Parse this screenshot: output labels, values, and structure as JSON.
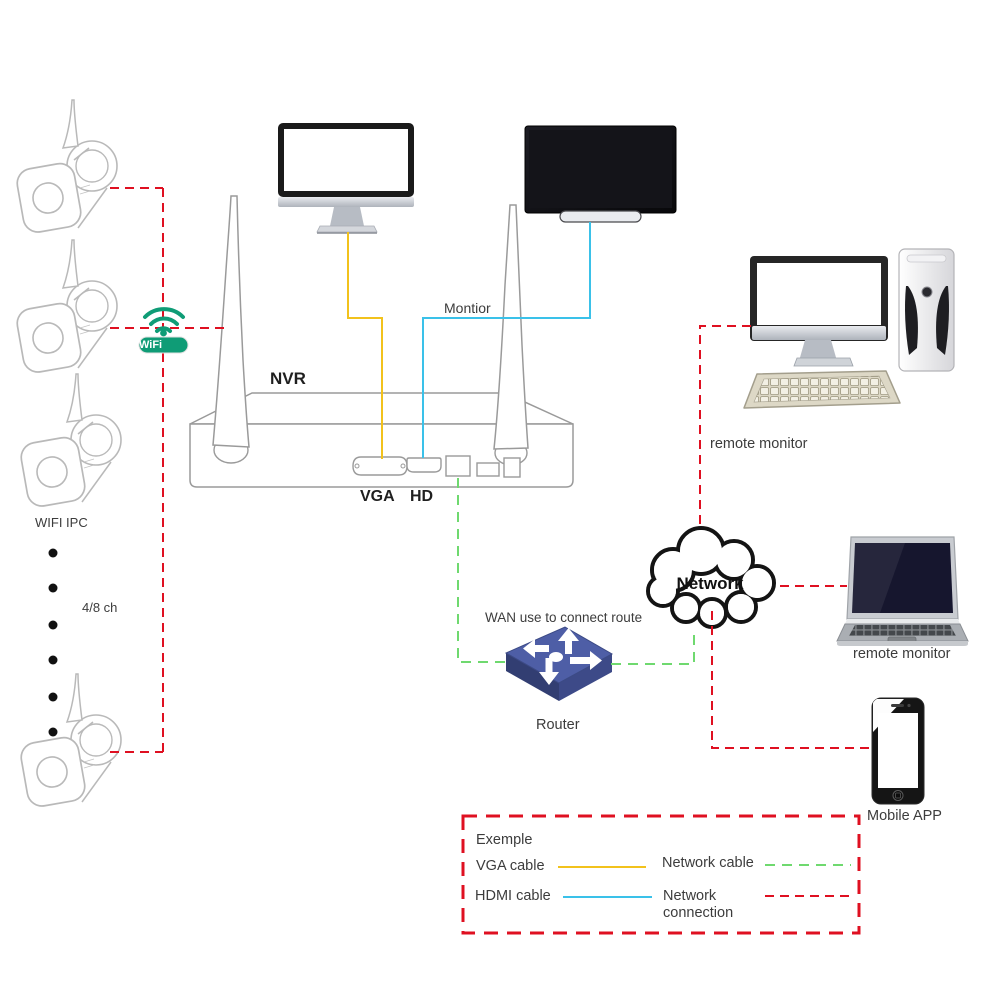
{
  "colors": {
    "red": "#df1021",
    "yellow": "#f2c21c",
    "cyan": "#3ac1e9",
    "green": "#6fd96f",
    "teal": "#0f9c76",
    "text": "#3c3c3c",
    "router-top": "#4e5ea6",
    "router-left": "#323e72",
    "router-right": "#3d4a88"
  },
  "labels": {
    "nvr": "NVR",
    "vga": "VGA",
    "hd": "HD",
    "monitor_cable": "Montior",
    "wifi_ipc": "WIFI IPC",
    "channels": "4/8 ch",
    "remote_pc": "remote monitor",
    "remote_laptop": "remote monitor",
    "network": "Network",
    "wan": "WAN use to connect route",
    "router": "Router",
    "mobile_app": "Mobile APP"
  },
  "wifi": {
    "label": "WiFi"
  },
  "legend": {
    "title": "Exemple",
    "items": [
      {
        "label": "VGA cable"
      },
      {
        "label": "Network cable"
      },
      {
        "label": "HDMI cable"
      },
      {
        "label": "Network\nconnection"
      }
    ]
  },
  "icons": {
    "wifi": "wifi-signal-icon",
    "camera": "bullet-camera-icon",
    "nvr": "nvr-device-icon",
    "monitor": "desktop-monitor-icon",
    "tv": "tv-icon",
    "pc_monitor": "pc-monitor-icon",
    "keyboard": "keyboard-icon",
    "tower": "pc-tower-icon",
    "cloud": "network-cloud-icon",
    "laptop": "laptop-icon",
    "router": "router-switch-icon",
    "phone": "smartphone-icon"
  }
}
